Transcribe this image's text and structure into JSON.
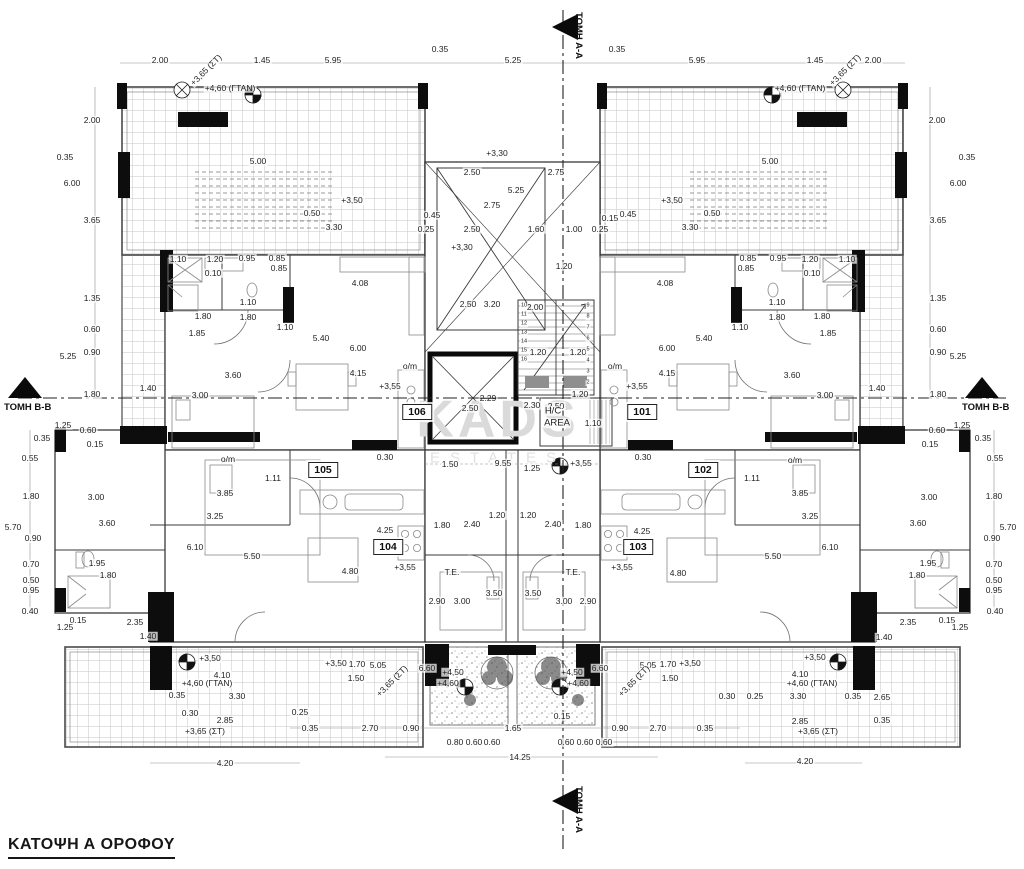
{
  "title": "ΚΑΤΟΨΗ Α ΟΡΟΦΟΥ",
  "watermark": {
    "line1": "KADS",
    "line2": "ESTATES"
  },
  "section_markers": {
    "top": "ΤΟΜΗ Α-Α",
    "bottom": "ΤΟΜΗ Α-Α",
    "left": "ΤΟΜΗ Β-Β",
    "right": "ΤΟΜΗ Β-Β"
  },
  "colors": {
    "walls": "#0a0a0a",
    "lines": "#3a3a3a",
    "hatch": "#c6c6c6",
    "watermark": "#dadada",
    "landing": "#8f8f8f"
  },
  "rooms": [
    {
      "num": "101",
      "x": 642,
      "y": 412
    },
    {
      "num": "102",
      "x": 703,
      "y": 470
    },
    {
      "num": "103",
      "x": 638,
      "y": 547
    },
    {
      "num": "104",
      "x": 388,
      "y": 547
    },
    {
      "num": "105",
      "x": 323,
      "y": 470
    },
    {
      "num": "106",
      "x": 417,
      "y": 412
    }
  ],
  "labels": [
    {
      "t": "2.00",
      "x": 160,
      "y": 60
    },
    {
      "t": "+3,65 (ΣΤ)",
      "x": 206,
      "y": 70,
      "r": -45
    },
    {
      "t": "1.45",
      "x": 262,
      "y": 60
    },
    {
      "t": "5.95",
      "x": 333,
      "y": 60
    },
    {
      "t": "0.35",
      "x": 440,
      "y": 49
    },
    {
      "t": "5.25",
      "x": 513,
      "y": 60
    },
    {
      "t": "0.35",
      "x": 617,
      "y": 49
    },
    {
      "t": "5.95",
      "x": 697,
      "y": 60
    },
    {
      "t": "1.45",
      "x": 815,
      "y": 60
    },
    {
      "t": "+3,65 (ΣΤ)",
      "x": 845,
      "y": 70,
      "r": -45
    },
    {
      "t": "2.00",
      "x": 873,
      "y": 60
    },
    {
      "t": "+4,60 (ΓΤΑΝ)",
      "x": 230,
      "y": 88
    },
    {
      "t": "+4,60 (ΓΤΑΝ)",
      "x": 800,
      "y": 88
    },
    {
      "t": "2.00",
      "x": 92,
      "y": 120
    },
    {
      "t": "2.00",
      "x": 937,
      "y": 120
    },
    {
      "t": "5.00",
      "x": 258,
      "y": 161
    },
    {
      "t": "5.00",
      "x": 770,
      "y": 161
    },
    {
      "t": "0.35",
      "x": 65,
      "y": 157
    },
    {
      "t": "0.35",
      "x": 967,
      "y": 157
    },
    {
      "t": "6.00",
      "x": 72,
      "y": 183
    },
    {
      "t": "6.00",
      "x": 958,
      "y": 183
    },
    {
      "t": "+3,50",
      "x": 352,
      "y": 200
    },
    {
      "t": "+3,50",
      "x": 672,
      "y": 200
    },
    {
      "t": "0.50",
      "x": 312,
      "y": 213
    },
    {
      "t": "3.30",
      "x": 334,
      "y": 227
    },
    {
      "t": "0.50",
      "x": 712,
      "y": 213
    },
    {
      "t": "3.30",
      "x": 690,
      "y": 227
    },
    {
      "t": "0.45",
      "x": 628,
      "y": 214
    },
    {
      "t": "3.65",
      "x": 92,
      "y": 220
    },
    {
      "t": "3.65",
      "x": 938,
      "y": 220
    },
    {
      "t": "1.35",
      "x": 92,
      "y": 298
    },
    {
      "t": "1.35",
      "x": 938,
      "y": 298
    },
    {
      "t": "0.60",
      "x": 92,
      "y": 329
    },
    {
      "t": "0.60",
      "x": 938,
      "y": 329
    },
    {
      "t": "0.90",
      "x": 92,
      "y": 352
    },
    {
      "t": "0.90",
      "x": 938,
      "y": 352
    },
    {
      "t": "5.25",
      "x": 68,
      "y": 356
    },
    {
      "t": "5.25",
      "x": 958,
      "y": 356
    },
    {
      "t": "1.80",
      "x": 92,
      "y": 394
    },
    {
      "t": "1.80",
      "x": 938,
      "y": 394
    },
    {
      "t": "+3,30",
      "x": 497,
      "y": 153
    },
    {
      "t": "2.50",
      "x": 472,
      "y": 172
    },
    {
      "t": "2.75",
      "x": 556,
      "y": 172
    },
    {
      "t": "5.25",
      "x": 516,
      "y": 190
    },
    {
      "t": "2.75",
      "x": 492,
      "y": 205
    },
    {
      "t": "0.45",
      "x": 432,
      "y": 215
    },
    {
      "t": "0.15",
      "x": 610,
      "y": 218
    },
    {
      "t": "0.25",
      "x": 426,
      "y": 229
    },
    {
      "t": "2.50",
      "x": 472,
      "y": 229
    },
    {
      "t": "1.60",
      "x": 536,
      "y": 229
    },
    {
      "t": "1.00",
      "x": 574,
      "y": 229
    },
    {
      "t": "0.25",
      "x": 600,
      "y": 229
    },
    {
      "t": "+3,30",
      "x": 462,
      "y": 247
    },
    {
      "t": "1.20",
      "x": 564,
      "y": 266
    },
    {
      "t": "2.50",
      "x": 468,
      "y": 304
    },
    {
      "t": "3.20",
      "x": 492,
      "y": 304
    },
    {
      "t": "2.00",
      "x": 535,
      "y": 307
    },
    {
      "t": "1.20",
      "x": 538,
      "y": 352
    },
    {
      "t": "1.20",
      "x": 578,
      "y": 352
    },
    {
      "t": "10",
      "x": 524,
      "y": 306,
      "fs": 5.5
    },
    {
      "t": "11",
      "x": 524,
      "y": 315,
      "fs": 5.5
    },
    {
      "t": "12",
      "x": 524,
      "y": 324,
      "fs": 5.5
    },
    {
      "t": "13",
      "x": 524,
      "y": 333,
      "fs": 5.5
    },
    {
      "t": "14",
      "x": 524,
      "y": 342,
      "fs": 5.5
    },
    {
      "t": "15",
      "x": 524,
      "y": 351,
      "fs": 5.5
    },
    {
      "t": "16",
      "x": 524,
      "y": 360,
      "fs": 5.5
    },
    {
      "t": "9",
      "x": 588,
      "y": 306,
      "fs": 5.5
    },
    {
      "t": "8",
      "x": 588,
      "y": 317,
      "fs": 5.5
    },
    {
      "t": "7",
      "x": 588,
      "y": 328,
      "fs": 5.5
    },
    {
      "t": "6",
      "x": 588,
      "y": 339,
      "fs": 5.5
    },
    {
      "t": "5",
      "x": 588,
      "y": 350,
      "fs": 5.5
    },
    {
      "t": "4",
      "x": 588,
      "y": 361,
      "fs": 5.5
    },
    {
      "t": "3",
      "x": 588,
      "y": 372,
      "fs": 5.5
    },
    {
      "t": "2",
      "x": 588,
      "y": 383,
      "fs": 5.5
    },
    {
      "t": "1.10",
      "x": 178,
      "y": 259
    },
    {
      "t": "1.20",
      "x": 215,
      "y": 259
    },
    {
      "t": "0.95",
      "x": 247,
      "y": 258
    },
    {
      "t": "0.85",
      "x": 277,
      "y": 258
    },
    {
      "t": "0.85",
      "x": 279,
      "y": 268
    },
    {
      "t": "0.10",
      "x": 213,
      "y": 273
    },
    {
      "t": "4.08",
      "x": 360,
      "y": 283
    },
    {
      "t": "1.10",
      "x": 248,
      "y": 302
    },
    {
      "t": "1.80",
      "x": 203,
      "y": 316
    },
    {
      "t": "1.80",
      "x": 248,
      "y": 317
    },
    {
      "t": "1.85",
      "x": 197,
      "y": 333
    },
    {
      "t": "1.10",
      "x": 285,
      "y": 327
    },
    {
      "t": "5.40",
      "x": 321,
      "y": 338
    },
    {
      "t": "6.00",
      "x": 358,
      "y": 348
    },
    {
      "t": "3.60",
      "x": 233,
      "y": 375
    },
    {
      "t": "4.15",
      "x": 358,
      "y": 373
    },
    {
      "t": "+3,55",
      "x": 390,
      "y": 386
    },
    {
      "t": "3.00",
      "x": 200,
      "y": 395
    },
    {
      "t": "1.40",
      "x": 148,
      "y": 388
    },
    {
      "t": "o/m",
      "x": 410,
      "y": 366
    },
    {
      "t": "1.10",
      "x": 847,
      "y": 259
    },
    {
      "t": "1.20",
      "x": 810,
      "y": 259
    },
    {
      "t": "0.95",
      "x": 778,
      "y": 258
    },
    {
      "t": "0.85",
      "x": 748,
      "y": 258
    },
    {
      "t": "0.85",
      "x": 746,
      "y": 268
    },
    {
      "t": "0.10",
      "x": 812,
      "y": 273
    },
    {
      "t": "4.08",
      "x": 665,
      "y": 283
    },
    {
      "t": "1.10",
      "x": 777,
      "y": 302
    },
    {
      "t": "1.80",
      "x": 822,
      "y": 316
    },
    {
      "t": "1.80",
      "x": 777,
      "y": 317
    },
    {
      "t": "1.85",
      "x": 828,
      "y": 333
    },
    {
      "t": "1.10",
      "x": 740,
      "y": 327
    },
    {
      "t": "5.40",
      "x": 704,
      "y": 338
    },
    {
      "t": "6.00",
      "x": 667,
      "y": 348
    },
    {
      "t": "3.60",
      "x": 792,
      "y": 375
    },
    {
      "t": "4.15",
      "x": 667,
      "y": 373
    },
    {
      "t": "+3,55",
      "x": 637,
      "y": 386
    },
    {
      "t": "3.00",
      "x": 825,
      "y": 395
    },
    {
      "t": "1.40",
      "x": 877,
      "y": 388
    },
    {
      "t": "o/m",
      "x": 615,
      "y": 366
    },
    {
      "t": "2.29",
      "x": 488,
      "y": 398,
      "strike": true
    },
    {
      "t": "2.50",
      "x": 470,
      "y": 408
    },
    {
      "t": "2.30",
      "x": 532,
      "y": 405
    },
    {
      "t": "2.50",
      "x": 556,
      "y": 406
    },
    {
      "t": "1.20",
      "x": 580,
      "y": 394
    },
    {
      "t": "1.10",
      "x": 593,
      "y": 423
    },
    {
      "t": "H/C",
      "x": 553,
      "y": 411,
      "fs": 9.5
    },
    {
      "t": "AREA",
      "x": 557,
      "y": 423,
      "fs": 9.5
    },
    {
      "t": "0.30",
      "x": 385,
      "y": 457
    },
    {
      "t": "0.30",
      "x": 643,
      "y": 457
    },
    {
      "t": "1.50",
      "x": 450,
      "y": 464
    },
    {
      "t": "9.55",
      "x": 503,
      "y": 463
    },
    {
      "t": "1.25",
      "x": 532,
      "y": 468
    },
    {
      "t": "+3,55",
      "x": 581,
      "y": 463
    },
    {
      "t": "1.11",
      "x": 273,
      "y": 478
    },
    {
      "t": "1.11",
      "x": 752,
      "y": 478
    },
    {
      "t": "o/m",
      "x": 228,
      "y": 459
    },
    {
      "t": "o/m",
      "x": 795,
      "y": 460
    },
    {
      "t": "3.85",
      "x": 225,
      "y": 493
    },
    {
      "t": "3.85",
      "x": 800,
      "y": 493
    },
    {
      "t": "3.25",
      "x": 215,
      "y": 516
    },
    {
      "t": "3.25",
      "x": 810,
      "y": 516
    },
    {
      "t": "6.10",
      "x": 195,
      "y": 547
    },
    {
      "t": "6.10",
      "x": 830,
      "y": 547
    },
    {
      "t": "5.50",
      "x": 252,
      "y": 556
    },
    {
      "t": "5.50",
      "x": 773,
      "y": 556
    },
    {
      "t": "4.25",
      "x": 385,
      "y": 530
    },
    {
      "t": "4.25",
      "x": 642,
      "y": 531
    },
    {
      "t": "1.80",
      "x": 442,
      "y": 525
    },
    {
      "t": "2.40",
      "x": 472,
      "y": 524
    },
    {
      "t": "1.20",
      "x": 497,
      "y": 515
    },
    {
      "t": "1.80",
      "x": 583,
      "y": 525
    },
    {
      "t": "2.40",
      "x": 553,
      "y": 524
    },
    {
      "t": "1.20",
      "x": 528,
      "y": 515
    },
    {
      "t": "4.80",
      "x": 350,
      "y": 571
    },
    {
      "t": "4.80",
      "x": 678,
      "y": 573
    },
    {
      "t": "+3,55",
      "x": 405,
      "y": 567
    },
    {
      "t": "+3,55",
      "x": 622,
      "y": 567
    },
    {
      "t": "T.E.",
      "x": 452,
      "y": 572
    },
    {
      "t": "T.E.",
      "x": 573,
      "y": 572
    },
    {
      "t": "1.25",
      "x": 63,
      "y": 425
    },
    {
      "t": "0.60",
      "x": 88,
      "y": 430
    },
    {
      "t": "0.35",
      "x": 42,
      "y": 438
    },
    {
      "t": "0.15",
      "x": 95,
      "y": 444
    },
    {
      "t": "0.55",
      "x": 30,
      "y": 458
    },
    {
      "t": "1.80",
      "x": 31,
      "y": 496
    },
    {
      "t": "5.70",
      "x": 13,
      "y": 527
    },
    {
      "t": "3.00",
      "x": 96,
      "y": 497
    },
    {
      "t": "0.90",
      "x": 33,
      "y": 538
    },
    {
      "t": "3.60",
      "x": 107,
      "y": 523
    },
    {
      "t": "0.70",
      "x": 31,
      "y": 564
    },
    {
      "t": "1.95",
      "x": 97,
      "y": 563
    },
    {
      "t": "0.50",
      "x": 31,
      "y": 580
    },
    {
      "t": "1.80",
      "x": 108,
      "y": 575
    },
    {
      "t": "0.95",
      "x": 31,
      "y": 590
    },
    {
      "t": "0.40",
      "x": 30,
      "y": 611
    },
    {
      "t": "0.15",
      "x": 78,
      "y": 620
    },
    {
      "t": "1.25",
      "x": 65,
      "y": 627
    },
    {
      "t": "1.25",
      "x": 962,
      "y": 425
    },
    {
      "t": "0.60",
      "x": 937,
      "y": 430
    },
    {
      "t": "0.35",
      "x": 983,
      "y": 438
    },
    {
      "t": "0.15",
      "x": 930,
      "y": 444
    },
    {
      "t": "0.55",
      "x": 995,
      "y": 458
    },
    {
      "t": "1.80",
      "x": 994,
      "y": 496
    },
    {
      "t": "5.70",
      "x": 1008,
      "y": 527
    },
    {
      "t": "3.00",
      "x": 929,
      "y": 497
    },
    {
      "t": "0.90",
      "x": 992,
      "y": 538
    },
    {
      "t": "3.60",
      "x": 918,
      "y": 523
    },
    {
      "t": "0.70",
      "x": 994,
      "y": 564
    },
    {
      "t": "1.95",
      "x": 928,
      "y": 563
    },
    {
      "t": "0.50",
      "x": 994,
      "y": 580
    },
    {
      "t": "1.80",
      "x": 917,
      "y": 575
    },
    {
      "t": "0.95",
      "x": 994,
      "y": 590
    },
    {
      "t": "0.40",
      "x": 995,
      "y": 611
    },
    {
      "t": "0.15",
      "x": 947,
      "y": 620
    },
    {
      "t": "1.25",
      "x": 960,
      "y": 627
    },
    {
      "t": "2.35",
      "x": 135,
      "y": 622
    },
    {
      "t": "2.35",
      "x": 908,
      "y": 622
    },
    {
      "t": "1.40",
      "x": 148,
      "y": 636
    },
    {
      "t": "1.40",
      "x": 884,
      "y": 637
    },
    {
      "t": "2.90",
      "x": 437,
      "y": 601
    },
    {
      "t": "3.00",
      "x": 462,
      "y": 601
    },
    {
      "t": "3.50",
      "x": 494,
      "y": 593
    },
    {
      "t": "3.50",
      "x": 533,
      "y": 593
    },
    {
      "t": "3.00",
      "x": 564,
      "y": 601
    },
    {
      "t": "2.90",
      "x": 588,
      "y": 601
    },
    {
      "t": "+3,50",
      "x": 210,
      "y": 658
    },
    {
      "t": "4.10",
      "x": 222,
      "y": 675
    },
    {
      "t": "+4,60 (ΓΤΑΝ)",
      "x": 207,
      "y": 683
    },
    {
      "t": "0.35",
      "x": 177,
      "y": 695
    },
    {
      "t": "3.30",
      "x": 237,
      "y": 696
    },
    {
      "t": "0.30",
      "x": 190,
      "y": 713
    },
    {
      "t": "2.85",
      "x": 225,
      "y": 720
    },
    {
      "t": "+3,65 (ΣΤ)",
      "x": 205,
      "y": 731
    },
    {
      "t": "4.20",
      "x": 225,
      "y": 763
    },
    {
      "t": "0.25",
      "x": 300,
      "y": 712
    },
    {
      "t": "0.35",
      "x": 310,
      "y": 728
    },
    {
      "t": "2.70",
      "x": 370,
      "y": 728
    },
    {
      "t": "0.90",
      "x": 411,
      "y": 728
    },
    {
      "t": "+3,50",
      "x": 336,
      "y": 663
    },
    {
      "t": "1.70",
      "x": 357,
      "y": 664
    },
    {
      "t": "5.05",
      "x": 378,
      "y": 665
    },
    {
      "t": "1.50",
      "x": 356,
      "y": 678
    },
    {
      "t": "+3,65 (ΣΤ)",
      "x": 392,
      "y": 681,
      "r": -45
    },
    {
      "t": "6.60",
      "x": 427,
      "y": 668
    },
    {
      "t": "+4,50",
      "x": 453,
      "y": 672
    },
    {
      "t": "+4,60",
      "x": 448,
      "y": 683
    },
    {
      "t": "+4,50",
      "x": 572,
      "y": 672
    },
    {
      "t": "+4,60",
      "x": 578,
      "y": 683
    },
    {
      "t": "6.60",
      "x": 600,
      "y": 668
    },
    {
      "t": "+3,50",
      "x": 690,
      "y": 663
    },
    {
      "t": "1.70",
      "x": 668,
      "y": 664
    },
    {
      "t": "5.05",
      "x": 648,
      "y": 665
    },
    {
      "t": "1.50",
      "x": 670,
      "y": 678
    },
    {
      "t": "+3,65 (ΣΤ)",
      "x": 634,
      "y": 681,
      "r": -45
    },
    {
      "t": "0.80",
      "x": 455,
      "y": 742
    },
    {
      "t": "0.60",
      "x": 474,
      "y": 742
    },
    {
      "t": "0.60",
      "x": 492,
      "y": 742
    },
    {
      "t": "1.65",
      "x": 513,
      "y": 728
    },
    {
      "t": "0.15",
      "x": 562,
      "y": 716
    },
    {
      "t": "0.60",
      "x": 566,
      "y": 742
    },
    {
      "t": "0.60",
      "x": 585,
      "y": 742
    },
    {
      "t": "0.60",
      "x": 604,
      "y": 742
    },
    {
      "t": "0.90",
      "x": 620,
      "y": 728
    },
    {
      "t": "2.70",
      "x": 658,
      "y": 728
    },
    {
      "t": "0.35",
      "x": 705,
      "y": 728
    },
    {
      "t": "14.25",
      "x": 520,
      "y": 757
    },
    {
      "t": "+3,50",
      "x": 815,
      "y": 657
    },
    {
      "t": "4.10",
      "x": 800,
      "y": 674
    },
    {
      "t": "+4,60 (ΓΤΑΝ)",
      "x": 812,
      "y": 683
    },
    {
      "t": "0.30",
      "x": 727,
      "y": 696
    },
    {
      "t": "0.25",
      "x": 755,
      "y": 696
    },
    {
      "t": "3.30",
      "x": 798,
      "y": 696
    },
    {
      "t": "0.35",
      "x": 853,
      "y": 696
    },
    {
      "t": "2.85",
      "x": 800,
      "y": 721
    },
    {
      "t": "2.65",
      "x": 882,
      "y": 697
    },
    {
      "t": "0.35",
      "x": 882,
      "y": 720
    },
    {
      "t": "+3,65 (ΣΤ)",
      "x": 818,
      "y": 731
    },
    {
      "t": "4.20",
      "x": 805,
      "y": 761
    }
  ]
}
